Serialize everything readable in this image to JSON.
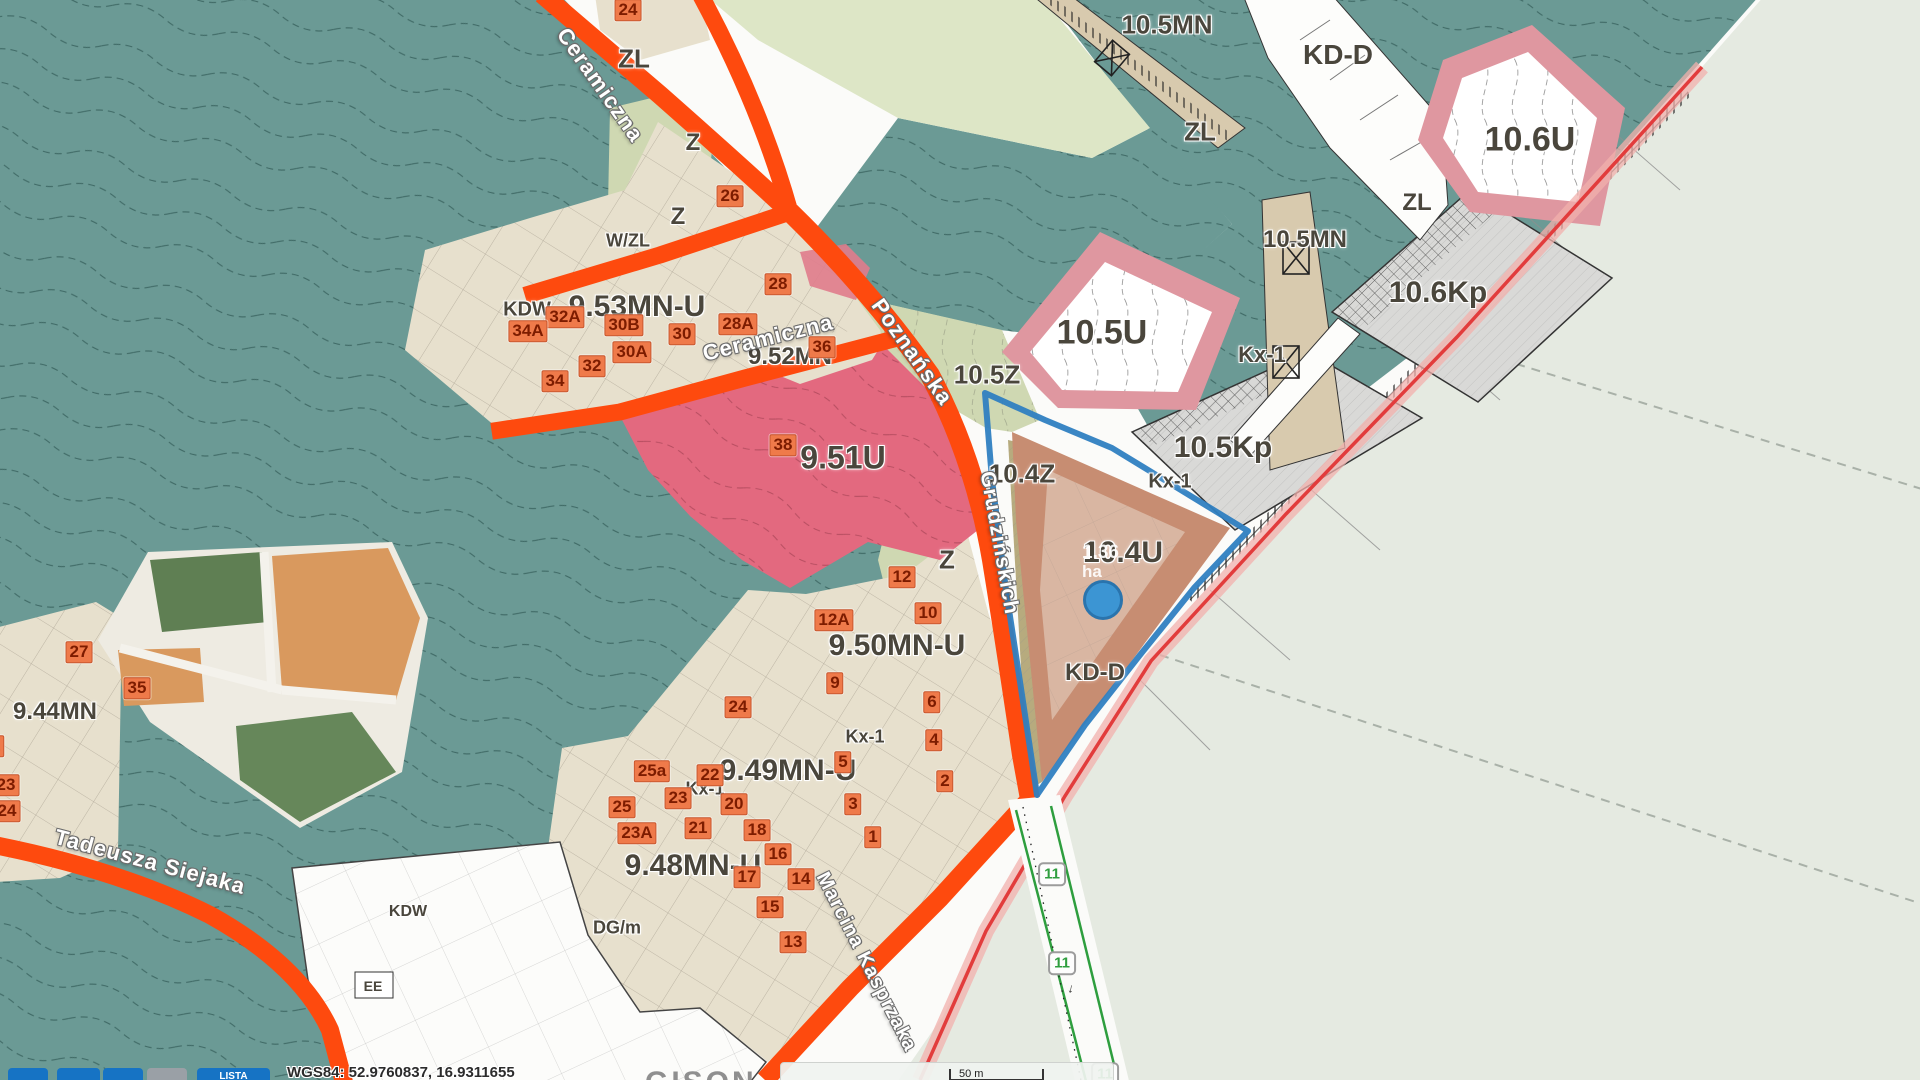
{
  "map": {
    "zone_labels": [
      {
        "text": "ZL",
        "x": 634,
        "y": 59,
        "size": 26
      },
      {
        "text": "Z",
        "x": 693,
        "y": 143,
        "size": 24
      },
      {
        "text": "Z",
        "x": 678,
        "y": 217,
        "size": 24
      },
      {
        "text": "W/ZL",
        "x": 628,
        "y": 241,
        "size": 18
      },
      {
        "text": "9.53MN-U",
        "x": 637,
        "y": 307,
        "size": 30
      },
      {
        "text": "KDW",
        "x": 527,
        "y": 310,
        "size": 20
      },
      {
        "text": "9.52MN",
        "x": 790,
        "y": 357,
        "size": 24
      },
      {
        "text": "9.51U",
        "x": 843,
        "y": 458,
        "size": 32
      },
      {
        "text": "9.50MN-U",
        "x": 897,
        "y": 646,
        "size": 30
      },
      {
        "text": "9.49MN-U",
        "x": 788,
        "y": 771,
        "size": 30
      },
      {
        "text": "9.48MN-U",
        "x": 693,
        "y": 866,
        "size": 30
      },
      {
        "text": "9.44MN",
        "x": 55,
        "y": 712,
        "size": 24
      },
      {
        "text": "Kx-1",
        "x": 705,
        "y": 789,
        "size": 18
      },
      {
        "text": "Kx-1",
        "x": 865,
        "y": 737,
        "size": 18
      },
      {
        "text": "Kx-1",
        "x": 1170,
        "y": 482,
        "size": 20
      },
      {
        "text": "Kx-1",
        "x": 1262,
        "y": 355,
        "size": 22
      },
      {
        "text": "Z",
        "x": 947,
        "y": 560,
        "size": 26
      },
      {
        "text": "10.5Z",
        "x": 987,
        "y": 375,
        "size": 26
      },
      {
        "text": "10.4Z",
        "x": 1022,
        "y": 474,
        "size": 26
      },
      {
        "text": "10.5U",
        "x": 1102,
        "y": 333,
        "size": 34
      },
      {
        "text": "10.4U",
        "x": 1123,
        "y": 553,
        "size": 30
      },
      {
        "text": "10.5Kp",
        "x": 1223,
        "y": 448,
        "size": 30
      },
      {
        "text": "10.6Kp",
        "x": 1438,
        "y": 293,
        "size": 30
      },
      {
        "text": "10.5MN",
        "x": 1167,
        "y": 25,
        "size": 26
      },
      {
        "text": "10.5MN",
        "x": 1305,
        "y": 240,
        "size": 24
      },
      {
        "text": "10.6U",
        "x": 1530,
        "y": 140,
        "size": 34
      },
      {
        "text": "ZL",
        "x": 1200,
        "y": 132,
        "size": 26
      },
      {
        "text": "ZL",
        "x": 1417,
        "y": 203,
        "size": 24
      },
      {
        "text": "KD-D",
        "x": 1338,
        "y": 55,
        "size": 28
      },
      {
        "text": "KD-D",
        "x": 1095,
        "y": 673,
        "size": 24
      },
      {
        "text": "KDW",
        "x": 408,
        "y": 912,
        "size": 16
      },
      {
        "text": "DG/m",
        "x": 617,
        "y": 928,
        "size": 18
      },
      {
        "text": "EE",
        "x": 373,
        "y": 986,
        "size": 14
      }
    ],
    "street_labels": [
      {
        "text": "Ceramiczna",
        "x": 600,
        "y": 85,
        "rotate": 55,
        "size": 22
      },
      {
        "text": "Ceramiczna",
        "x": 768,
        "y": 338,
        "rotate": -14,
        "size": 22
      },
      {
        "text": "Poznańska",
        "x": 912,
        "y": 352,
        "rotate": 55,
        "size": 22
      },
      {
        "text": "Grudzińskich",
        "x": 999,
        "y": 543,
        "rotate": 80,
        "size": 21
      },
      {
        "text": "Marcina Kasprzaka",
        "x": 866,
        "y": 962,
        "rotate": 63,
        "size": 20
      },
      {
        "text": "Tadeusza Siejaka",
        "x": 150,
        "y": 862,
        "rotate": 15,
        "size": 22
      }
    ],
    "address_badges": [
      {
        "text": "24",
        "x": 628,
        "y": 10
      },
      {
        "text": "26",
        "x": 730,
        "y": 196
      },
      {
        "text": "28",
        "x": 778,
        "y": 284
      },
      {
        "text": "32A",
        "x": 565,
        "y": 317
      },
      {
        "text": "34A",
        "x": 528,
        "y": 331
      },
      {
        "text": "30B",
        "x": 624,
        "y": 325
      },
      {
        "text": "30",
        "x": 682,
        "y": 334
      },
      {
        "text": "28A",
        "x": 738,
        "y": 324
      },
      {
        "text": "30A",
        "x": 632,
        "y": 352
      },
      {
        "text": "32",
        "x": 592,
        "y": 366
      },
      {
        "text": "34",
        "x": 555,
        "y": 381
      },
      {
        "text": "36",
        "x": 822,
        "y": 347
      },
      {
        "text": "38",
        "x": 783,
        "y": 445
      },
      {
        "text": "12",
        "x": 902,
        "y": 577
      },
      {
        "text": "12A",
        "x": 834,
        "y": 620
      },
      {
        "text": "10",
        "x": 928,
        "y": 613
      },
      {
        "text": "9",
        "x": 835,
        "y": 683
      },
      {
        "text": "24",
        "x": 738,
        "y": 707
      },
      {
        "text": "6",
        "x": 932,
        "y": 702
      },
      {
        "text": "4",
        "x": 934,
        "y": 740
      },
      {
        "text": "2",
        "x": 945,
        "y": 781
      },
      {
        "text": "5",
        "x": 843,
        "y": 762
      },
      {
        "text": "3",
        "x": 853,
        "y": 804
      },
      {
        "text": "1",
        "x": 873,
        "y": 837
      },
      {
        "text": "25a",
        "x": 652,
        "y": 771
      },
      {
        "text": "22",
        "x": 710,
        "y": 775
      },
      {
        "text": "23",
        "x": 678,
        "y": 798
      },
      {
        "text": "20",
        "x": 734,
        "y": 804
      },
      {
        "text": "25",
        "x": 622,
        "y": 807
      },
      {
        "text": "23A",
        "x": 637,
        "y": 833
      },
      {
        "text": "21",
        "x": 698,
        "y": 828
      },
      {
        "text": "18",
        "x": 757,
        "y": 830
      },
      {
        "text": "16",
        "x": 778,
        "y": 854
      },
      {
        "text": "17",
        "x": 747,
        "y": 877
      },
      {
        "text": "14",
        "x": 801,
        "y": 879
      },
      {
        "text": "15",
        "x": 770,
        "y": 907
      },
      {
        "text": "13",
        "x": 793,
        "y": 942
      },
      {
        "text": "27",
        "x": 79,
        "y": 652
      },
      {
        "text": "35",
        "x": 137,
        "y": 688
      },
      {
        "text": "23",
        "x": 6,
        "y": 785
      },
      {
        "text": "24",
        "x": 7,
        "y": 811
      },
      {
        "text": "2",
        "x": -4,
        "y": 746
      }
    ],
    "route_markers": [
      {
        "text": "11",
        "x": 1052,
        "y": 874
      },
      {
        "text": "11",
        "x": 1062,
        "y": 963
      },
      {
        "text": "11",
        "x": 1105,
        "y": 1074
      }
    ],
    "route_arrow": "↓",
    "selected_area": {
      "value": "1.36",
      "unit": "ha",
      "x": 1082,
      "y": 543
    },
    "marker": {
      "x": 1103,
      "y": 600
    },
    "colors": {
      "forest": "#6b9a95",
      "zone_beige": "#e7e0cd",
      "zone_green": "#cfd8b2",
      "pale_green": "#dde6c6",
      "zone_pink": "#e3697f",
      "pink_border": "#df97a0",
      "zone_gray": "#d9d9d7",
      "tan_strip": "#d8caae",
      "road_orange": "#fe4a0e",
      "selection_blue": "#2f7fc1",
      "marker_blue": "#2f93d8",
      "sea": "#e5eae1",
      "coast_red": "#e23c3c",
      "route_green": "#2e9e3e",
      "badge_bg": "#ef7a4a"
    },
    "statusbar": {
      "coords_text": "WGS84: 52.9760837, 16.9311655",
      "buttons": [
        {
          "label": "",
          "color": "#1673c4",
          "x": 8,
          "w": 40
        },
        {
          "label": "",
          "color": "#1673c4",
          "x": 57,
          "w": 43
        },
        {
          "label": "",
          "color": "#1673c4",
          "x": 103,
          "w": 40
        },
        {
          "label": "",
          "color": "#9aa0a6",
          "x": 147,
          "w": 40
        },
        {
          "label": "LISTA",
          "color": "#1673c4",
          "x": 197,
          "w": 73
        }
      ],
      "scale_text": "50 m",
      "watermark": "GISON"
    }
  }
}
